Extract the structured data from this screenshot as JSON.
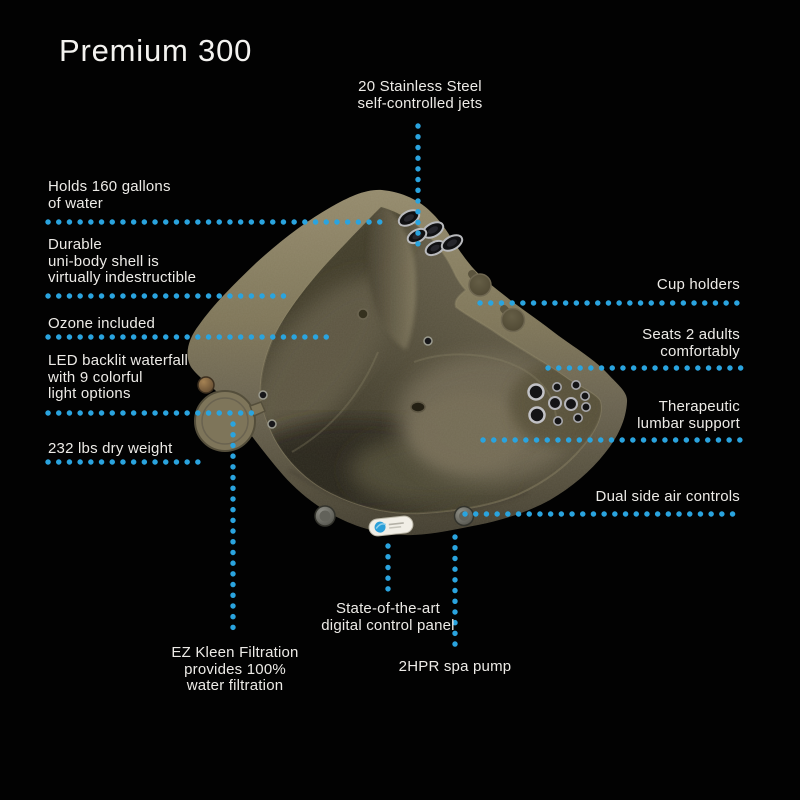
{
  "title": "Premium 300",
  "callouts": {
    "jets": "20 Stainless Steel\nself-controlled jets",
    "gallons": "Holds 160 gallons\nof water",
    "shell": "Durable\nuni-body shell is\nvirtually indestructible",
    "ozone": "Ozone included",
    "waterfall": "LED backlit waterfall\nwith 9 colorful\nlight options",
    "weight": "232 lbs dry weight",
    "cup_holders": "Cup holders",
    "seats": "Seats 2 adults\ncomfortably",
    "lumbar": "Therapeutic\nlumbar support",
    "air_controls": "Dual side air controls",
    "control_panel": "State-of-the-art\ndigital control panel",
    "filtration": "EZ Kleen Filtration\nprovides 100%\nwater filtration",
    "pump": "2HPR spa pump"
  },
  "colors": {
    "background": "#020202",
    "leader_dots": "#2aa4df",
    "text": "#edebe7",
    "shell_tan_light": "#948a6c",
    "shell_tan_dark": "#433e30",
    "bowl_olive": "#554f3c"
  }
}
